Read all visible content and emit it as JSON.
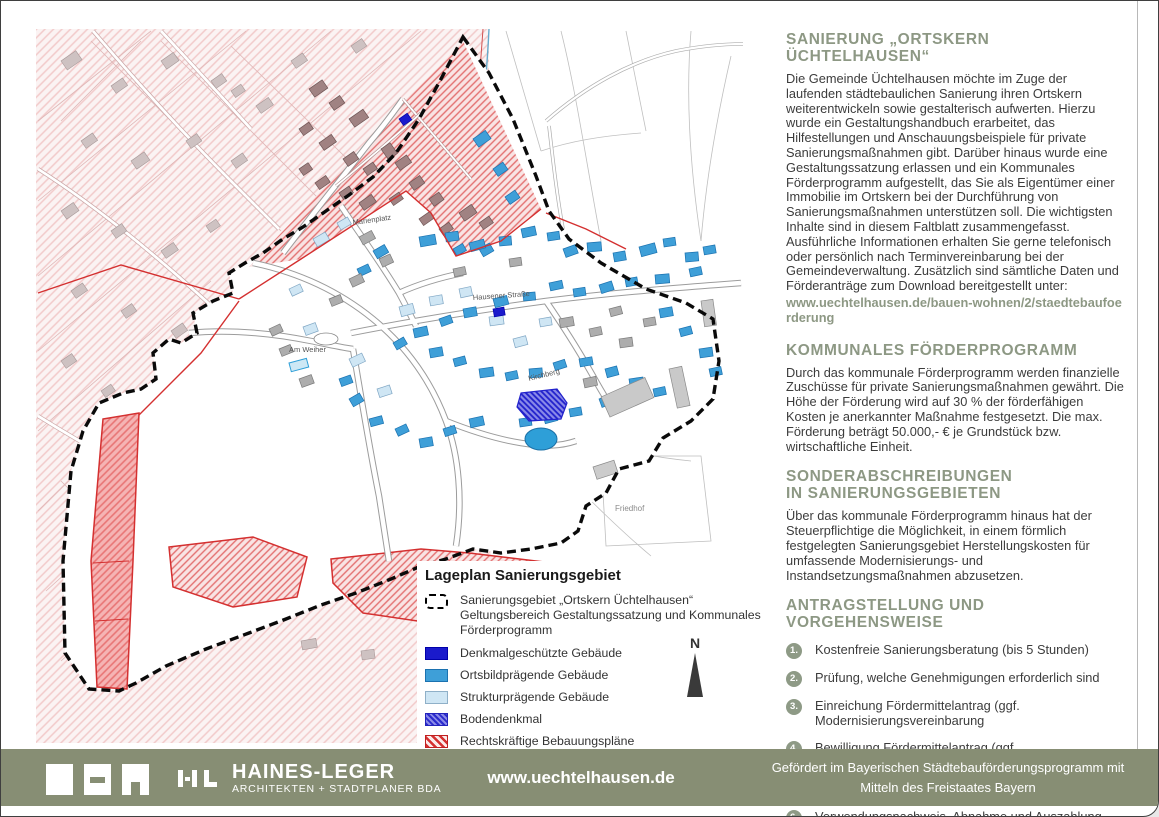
{
  "right_column": {
    "s1": {
      "heading": "SANIERUNG „ORTSKERN ÜCHTELHAUSEN“",
      "body": "Die Gemeinde Üchtelhausen möchte im Zuge der laufenden städtebaulichen Sanierung ihren Ortskern weiterentwickeln sowie gestalterisch aufwerten. Hierzu wurde ein Gestaltungshandbuch erarbeitet, das Hilfestellungen und Anschauungsbeispiele für private Sanierungsmaßnahmen gibt. Darüber hinaus wurde eine Gestaltungssatzung erlassen und ein Kommunales Förderprogramm aufgestellt, das Sie als Eigentümer einer Immobilie im Ortskern bei der Durchführung von Sanierungsmaßnahmen unterstützen soll. Die wichtigsten Inhalte sind in diesem Faltblatt zusammengefasst. Ausführliche Informationen erhalten Sie gerne telefonisch oder persönlich nach Terminvereinbarung bei der Gemeindeverwaltung. Zusätzlich sind sämtliche Daten und Förderanträge zum Download bereitgestellt unter:",
      "link": "www.uechtelhausen.de/bauen-wohnen/2/staedtebaufoerderung"
    },
    "s2": {
      "heading": "KOMMUNALES FÖRDERPROGRAMM",
      "body": "Durch das kommunale Förderprogramm werden finanzielle Zuschüsse für private Sanierungsmaßnahmen gewährt. Die Höhe der Förderung wird auf 30 % der förderfähigen Kosten je anerkannter Maßnahme festgesetzt. Die max. Förderung beträgt 50.000,- € je Grundstück bzw. wirtschaftliche Einheit."
    },
    "s3": {
      "heading_line1": "SONDERABSCHREIBUNGEN",
      "heading_line2": "IN SANIERUNGSGEBIETEN",
      "body": "Über das kommunale Förderprogramm hinaus hat der Steuerpflichtige die Möglichkeit, in einem förmlich festgelegten Sanierungsgebiet Herstellungskosten für umfassende Modernisierungs- und Instandsetzungsmaßnahmen abzusetzen."
    },
    "s4": {
      "heading": "ANTRAGSTELLUNG UND VORGEHENSWEISE",
      "steps": [
        {
          "num": "1.",
          "text": "Kostenfreie Sanierungsberatung (bis 5 Stunden)"
        },
        {
          "num": "2.",
          "text": "Prüfung, welche Genehmigungen erforderlich sind"
        },
        {
          "num": "3.",
          "text": "Einreichung Fördermittelantrag (ggf. Modernisierungsvereinbarung"
        },
        {
          "num": "4.",
          "text": "Bewilligung Fördermittelantrag (ggf. Modernisierungsvereinbarung"
        },
        {
          "num": "5.",
          "text": "Maßnahmenbeginn/ -durchführung"
        },
        {
          "num": "6.",
          "text": "Verwendungsnachweis, Abnahme und Auszahlung"
        }
      ]
    }
  },
  "map": {
    "legend": {
      "title": "Lageplan Sanierungsgebiet",
      "items": [
        {
          "label": "Sanierungsgebiet „Ortskern Üchtelhausen“ Geltungsbereich Gestaltungssatzung und Kommunales Förderprogramm"
        },
        {
          "label": "Denkmalgeschützte Gebäude"
        },
        {
          "label": "Ortsbildprägende Gebäude"
        },
        {
          "label": "Strukturprägende Gebäude"
        },
        {
          "label": "Bodendenkmal"
        },
        {
          "label": "Rechtskräftige Bebauungspläne"
        }
      ]
    },
    "labels": [
      "Marienplatz",
      "Hausener Straße",
      "Kirchberg",
      "Am Weiher",
      "Friedhof"
    ],
    "north": "N"
  },
  "footer": {
    "brand": "HAINES-LEGER",
    "brand_sub": "ARCHITEKTEN + STADTPLANER BDA",
    "website": "www.uechtelhausen.de",
    "funding_line1": "Gefördert im Bayerischen Städtebauförderungsprogramm mit",
    "funding_line2": "Mitteln des Freistaates Bayern"
  },
  "colors": {
    "accent": "#8D9884",
    "footer_bg": "#878E74",
    "denkmal": "#1A1ACC",
    "ortsbild": "#3E9FD8",
    "struktur": "#CFE6F4",
    "bebauungsplan": "#D43030"
  }
}
